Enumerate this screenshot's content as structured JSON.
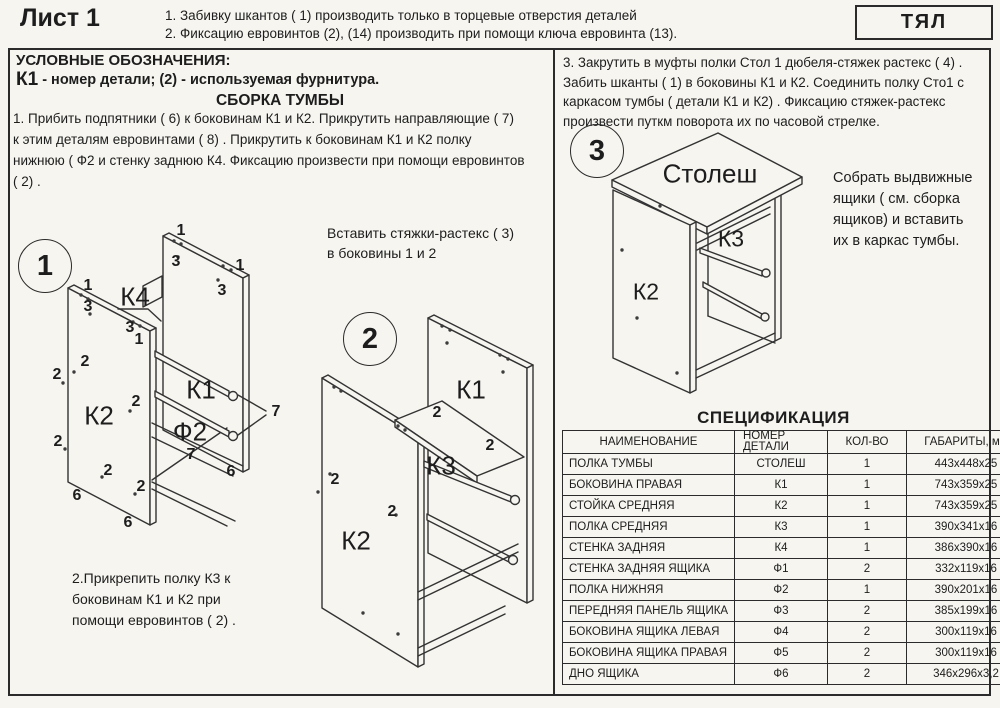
{
  "header": {
    "sheet": "Лист 1",
    "note1": "1. Забивку шкантов  ( 1)   производить только в торцевые отверстия деталей",
    "note2": "2. Фиксацию евровинтов (2), (14) производить при помощи ключа евровинта (13).",
    "brand": "ТЯЛ"
  },
  "legend": {
    "title": "УСЛОВНЫЕ ОБОЗНАЧЕНИЯ:",
    "part_code": "К1",
    "part_desc": " - номер детали;  (2) - используемая фурнитура."
  },
  "assembly": {
    "title": "СБОРКА ТУМБЫ",
    "step1": "1. Прибить подпятники  ( 6)   к боковинам  К1 и К2. Прикрутить направляющие  ( 7)\nк этим деталям евровинтами  ( 8) . Прикрутить к боковинам  К1 и К2 полку\nнижнюю  ( Ф2 и стенку заднюю К4. Фиксацию произвести при помощи евровинтов\n( 2)  .",
    "insert_note": "Вставить стяжки-растекс  ( 3)\nв боковины 1 и 2",
    "step2": "2.Прикрепить полку К3 к\nбоковинам К1 и К2 при\nпомощи евровинтов  ( 2) .",
    "step3": "3. Закрутить в муфты полки Стол 1 дюбеля-стяжек растекс  ( 4)  .\nЗабить шканты  ( 1)   в боковины К1 и К2.  Соединить полку Сто1 с\nкаркасом тумбы  ( детали К1 и К2)  . Фиксацию стяжек-растекс\nпроизвести путкм поворота их по часовой стрелке.",
    "drawer_note": "Собрать выдвижные\nящики  ( см. сборка\nящиков)   и вставить\nих в каркас тумбы."
  },
  "diagrams": [
    {
      "badge": "1",
      "bx": 45,
      "by": 266,
      "parts": [
        {
          "t": "К4",
          "x": 135,
          "y": 297
        },
        {
          "t": "К2",
          "x": 99,
          "y": 416
        },
        {
          "t": "К1",
          "x": 201,
          "y": 390
        },
        {
          "t": "Ф2",
          "x": 190,
          "y": 432
        }
      ],
      "callouts": [
        {
          "t": "1",
          "x": 181,
          "y": 231
        },
        {
          "t": "3",
          "x": 176,
          "y": 262
        },
        {
          "t": "1",
          "x": 240,
          "y": 266
        },
        {
          "t": "3",
          "x": 222,
          "y": 291
        },
        {
          "t": "1",
          "x": 88,
          "y": 286
        },
        {
          "t": "3",
          "x": 88,
          "y": 307
        },
        {
          "t": "3",
          "x": 130,
          "y": 328
        },
        {
          "t": "1",
          "x": 139,
          "y": 340
        },
        {
          "t": "2",
          "x": 85,
          "y": 362
        },
        {
          "t": "2",
          "x": 57,
          "y": 375
        },
        {
          "t": "2",
          "x": 136,
          "y": 402
        },
        {
          "t": "2",
          "x": 58,
          "y": 442
        },
        {
          "t": "7",
          "x": 276,
          "y": 412
        },
        {
          "t": "7",
          "x": 191,
          "y": 455
        },
        {
          "t": "6",
          "x": 231,
          "y": 472
        },
        {
          "t": "2",
          "x": 108,
          "y": 471
        },
        {
          "t": "2",
          "x": 141,
          "y": 487
        },
        {
          "t": "6",
          "x": 77,
          "y": 496
        },
        {
          "t": "6",
          "x": 128,
          "y": 523
        }
      ]
    },
    {
      "badge": "2",
      "bx": 370,
      "by": 339,
      "parts": [
        {
          "t": "К1",
          "x": 471,
          "y": 390
        },
        {
          "t": "К3",
          "x": 441,
          "y": 466
        },
        {
          "t": "К2",
          "x": 356,
          "y": 541
        }
      ],
      "callouts": [
        {
          "t": "2",
          "x": 437,
          "y": 413
        },
        {
          "t": "2",
          "x": 490,
          "y": 446
        },
        {
          "t": "2",
          "x": 335,
          "y": 480
        },
        {
          "t": "2",
          "x": 392,
          "y": 512
        }
      ]
    },
    {
      "badge": "3",
      "bx": 597,
      "by": 151,
      "parts": [
        {
          "t": "Столеш",
          "x": 710,
          "y": 174
        },
        {
          "t": "К3",
          "x": 731,
          "y": 239,
          "small": true
        },
        {
          "t": "К2",
          "x": 646,
          "y": 292,
          "small": true
        }
      ],
      "callouts": []
    }
  ],
  "spec_table": {
    "title": "СПЕЦИФИКАЦИЯ",
    "columns": [
      "НАИМЕНОВАНИЕ",
      "НОМЕР\nДЕТАЛИ",
      "КОЛ-ВО",
      "ГАБАРИТЫ, мм"
    ],
    "rows": [
      [
        "ПОЛКА ТУМБЫ",
        "СТОЛЕШ",
        "1",
        "443x448x25"
      ],
      [
        "БОКОВИНА ПРАВАЯ",
        "К1",
        "1",
        "743x359x25"
      ],
      [
        "СТОЙКА СРЕДНЯЯ",
        "К2",
        "1",
        "743x359x25"
      ],
      [
        "ПОЛКА  СРЕДНЯЯ",
        "К3",
        "1",
        "390x341x16"
      ],
      [
        "СТЕНКА ЗАДНЯЯ",
        "К4",
        "1",
        "386x390x16"
      ],
      [
        "СТЕНКА ЗАДНЯЯ ЯЩИКА",
        "Ф1",
        "2",
        "332x119x16"
      ],
      [
        "ПОЛКА НИЖНЯЯ",
        "Ф2",
        "1",
        "390x201x16"
      ],
      [
        "ПЕРЕДНЯЯ ПАНЕЛЬ ЯЩИКА",
        "Ф3",
        "2",
        "385x199x16"
      ],
      [
        "БОКОВИНА ЯЩИКА ЛЕВАЯ",
        "Ф4",
        "2",
        "300x119x16"
      ],
      [
        "БОКОВИНА ЯЩИКА ПРАВАЯ",
        "Ф5",
        "2",
        "300x119x16"
      ],
      [
        "ДНО ЯЩИКА",
        "Ф6",
        "2",
        "346x296x3,2"
      ]
    ]
  }
}
